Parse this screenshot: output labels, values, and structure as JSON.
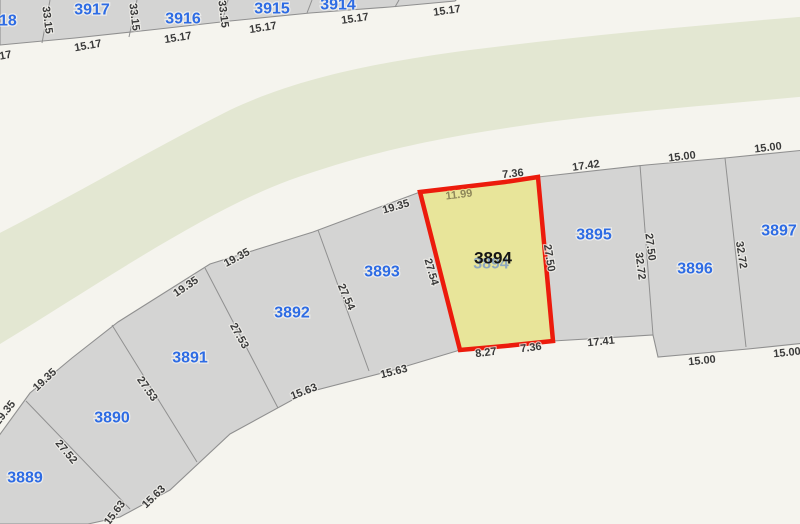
{
  "map": {
    "colors": {
      "background": "#f5f4ee",
      "greenway": "#e3e7d2",
      "parcel_fill": "#d4d4d3",
      "parcel_stroke": "#909090",
      "parcel_label": "#2e6ce4",
      "dimension_text": "#3a3a3a",
      "selected_fill": "#e8e59a",
      "selected_stroke": "#ec1b0c",
      "selected_dim": "#8e875a",
      "selected_underlay": "#86a2c3"
    },
    "selected_parcel_id": "3894",
    "parcel_labels": [
      {
        "text": "3918",
        "x": -1,
        "y": 21
      },
      {
        "text": "3917",
        "x": 92,
        "y": 10
      },
      {
        "text": "3916",
        "x": 183,
        "y": 19
      },
      {
        "text": "3915",
        "x": 272,
        "y": 9
      },
      {
        "text": "3914",
        "x": 338,
        "y": 5
      },
      {
        "text": "3889",
        "x": 25,
        "y": 478
      },
      {
        "text": "3890",
        "x": 112,
        "y": 418
      },
      {
        "text": "3891",
        "x": 190,
        "y": 358
      },
      {
        "text": "3892",
        "x": 292,
        "y": 313
      },
      {
        "text": "3893",
        "x": 382,
        "y": 272
      },
      {
        "text": "3895",
        "x": 594,
        "y": 235
      },
      {
        "text": "3896",
        "x": 695,
        "y": 269
      },
      {
        "text": "3897",
        "x": 779,
        "y": 231
      },
      {
        "text": "3894",
        "x": 491,
        "y": 264,
        "cls": "underlay"
      },
      {
        "text": "3894",
        "x": 493,
        "y": 258,
        "cls": "selected"
      }
    ],
    "dimension_labels": [
      {
        "text": "33.15",
        "x": 47,
        "y": 20,
        "rot": 83
      },
      {
        "text": "33.15",
        "x": 134,
        "y": 17,
        "rot": 83
      },
      {
        "text": "33.15",
        "x": 223,
        "y": 14,
        "rot": 83
      },
      {
        "text": "15.17",
        "x": -2,
        "y": 57,
        "rot": -10
      },
      {
        "text": "15.17",
        "x": 88,
        "y": 46,
        "rot": -10
      },
      {
        "text": "15.17",
        "x": 178,
        "y": 38,
        "rot": -9
      },
      {
        "text": "15.17",
        "x": 263,
        "y": 28,
        "rot": -9
      },
      {
        "text": "15.17",
        "x": 355,
        "y": 19,
        "rot": -8
      },
      {
        "text": "15.17",
        "x": 447,
        "y": 11,
        "rot": -8
      },
      {
        "text": "19.35",
        "x": 5,
        "y": 413,
        "rot": -52
      },
      {
        "text": "19.35",
        "x": 45,
        "y": 380,
        "rot": -43
      },
      {
        "text": "19.35",
        "x": 186,
        "y": 287,
        "rot": -34
      },
      {
        "text": "19.35",
        "x": 237,
        "y": 258,
        "rot": -28
      },
      {
        "text": "19.35",
        "x": 396,
        "y": 207,
        "rot": -16
      },
      {
        "text": "11.99",
        "x": 459,
        "y": 195,
        "rot": -7,
        "cls": "selected-dim"
      },
      {
        "text": "7.36",
        "x": 513,
        "y": 174,
        "rot": -6
      },
      {
        "text": "17.42",
        "x": 586,
        "y": 166,
        "rot": -8
      },
      {
        "text": "15.00",
        "x": 682,
        "y": 157,
        "rot": -7
      },
      {
        "text": "15.00",
        "x": 768,
        "y": 148,
        "rot": -7
      },
      {
        "text": "27.52",
        "x": 66,
        "y": 452,
        "rot": 50
      },
      {
        "text": "27.53",
        "x": 147,
        "y": 389,
        "rot": 55
      },
      {
        "text": "27.53",
        "x": 239,
        "y": 336,
        "rot": 61
      },
      {
        "text": "27.54",
        "x": 346,
        "y": 297,
        "rot": 66
      },
      {
        "text": "27.54",
        "x": 431,
        "y": 272,
        "rot": 74
      },
      {
        "text": "27.50",
        "x": 549,
        "y": 258,
        "rot": 81
      },
      {
        "text": "27.50",
        "x": 650,
        "y": 247,
        "rot": 83
      },
      {
        "text": "32.72",
        "x": 640,
        "y": 266,
        "rot": 83
      },
      {
        "text": "32.72",
        "x": 741,
        "y": 255,
        "rot": 81
      },
      {
        "text": "15.63",
        "x": 115,
        "y": 513,
        "rot": -53
      },
      {
        "text": "15.63",
        "x": 154,
        "y": 497,
        "rot": -44
      },
      {
        "text": "15.63",
        "x": 304,
        "y": 392,
        "rot": -21
      },
      {
        "text": "15.63",
        "x": 394,
        "y": 372,
        "rot": -14
      },
      {
        "text": "8.27",
        "x": 486,
        "y": 353,
        "rot": -7
      },
      {
        "text": "7.36",
        "x": 531,
        "y": 348,
        "rot": -7
      },
      {
        "text": "17.41",
        "x": 601,
        "y": 342,
        "rot": -6
      },
      {
        "text": "15.00",
        "x": 702,
        "y": 361,
        "rot": -6
      },
      {
        "text": "15.00",
        "x": 787,
        "y": 353,
        "rot": -6
      }
    ]
  }
}
